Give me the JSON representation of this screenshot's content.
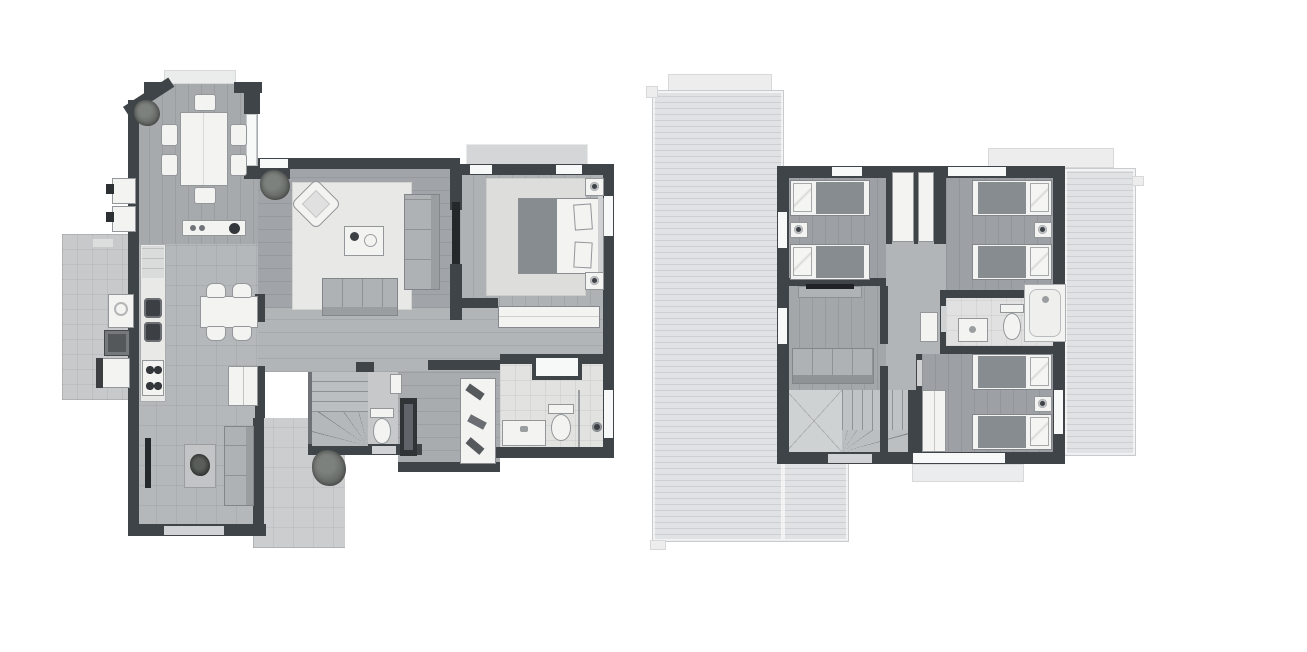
{
  "canvas": {
    "width_px": 1307,
    "height_px": 652,
    "background": "#ffffff"
  },
  "figure": {
    "type": "architectural-floor-plan",
    "style": "grayscale top-down 2D render, two storeys side by side",
    "plan_count": 2,
    "visible_text_labels": []
  },
  "colors": {
    "background": "#ffffff",
    "wall": "#3f4448",
    "wall_dark": "#24282b",
    "window": "#f7f8f8",
    "threshold": "#d0d2d3",
    "floor_wood": "#a1a5a9",
    "floor_wood_light": "#aeb2b5",
    "floor_tile_kitchen": "#b5b8ba",
    "floor_hall": "#b2b5b8",
    "floor_bath": "#e2e2e0",
    "rug": "#e8e8e6",
    "rug_bed": "#dddedc",
    "roof": "#e0e2e4",
    "roof_line": "#cdd0d2",
    "terrace": "#cbcdce",
    "patio": "#c7c9ca",
    "stairwell": "#cfd2d3",
    "furniture_white": "#f3f3f2",
    "furniture_outline": "#94979a",
    "sofa_gray": "#aeb2b5",
    "blanket": "#878c90",
    "counter": "#e9e9e8",
    "fixture_dark": "#3c4044",
    "plant": "#5f6360"
  },
  "plans": [
    {
      "id": "ground-floor",
      "side": "left",
      "rooms": [
        {
          "name": "dining-room",
          "items": [
            "dining-table",
            "dining-chair-x6",
            "plant",
            "entry-step",
            "chamfered-corner-wall"
          ]
        },
        {
          "name": "living-room",
          "items": [
            "area-rug",
            "sofa",
            "loveseat",
            "armchair",
            "coffee-table",
            "plant"
          ]
        },
        {
          "name": "master-bedroom",
          "items": [
            "double-bed",
            "pillow-x2",
            "nightstand-x2",
            "table-lamp-x2",
            "area-rug",
            "wall-tv",
            "terrace-deck",
            "window-x3"
          ]
        },
        {
          "name": "kitchen",
          "items": [
            "counter-run",
            "double-sink",
            "cooktop",
            "refrigerator",
            "breakfast-table",
            "chair-x4",
            "island-counter"
          ]
        },
        {
          "name": "family-room",
          "items": [
            "sofa",
            "side-table-with-plant",
            "wall-tv",
            "terrace-door"
          ]
        },
        {
          "name": "hallway",
          "items": [
            "built-in-wardrobe"
          ]
        },
        {
          "name": "walk-in-closet",
          "items": [
            "shelving-unit",
            "tall-cabinet"
          ]
        },
        {
          "name": "bathroom",
          "items": [
            "vanity-sink",
            "toilet",
            "shower",
            "window",
            "niche"
          ]
        },
        {
          "name": "powder-room",
          "items": [
            "toilet",
            "hand-basin"
          ]
        },
        {
          "name": "staircase",
          "items": [
            "straight-treads",
            "winder-treads"
          ]
        },
        {
          "name": "laundry-patio",
          "items": [
            "washer",
            "dryer",
            "utility-sink",
            "meter-box-x2",
            "step"
          ]
        },
        {
          "name": "terrace",
          "items": [
            "plant",
            "tiled-floor"
          ]
        }
      ]
    },
    {
      "id": "upper-floor",
      "side": "right",
      "rooms": [
        {
          "name": "bedroom-2",
          "items": [
            "twin-bed-x2",
            "pillow-x2",
            "nightstand",
            "table-lamp",
            "closet"
          ]
        },
        {
          "name": "bedroom-3",
          "items": [
            "twin-bed-x2",
            "pillow-x2",
            "nightstand",
            "table-lamp",
            "closet"
          ]
        },
        {
          "name": "bedroom-4",
          "items": [
            "twin-bed-x2",
            "pillow-x2",
            "nightstand",
            "table-lamp",
            "closet"
          ]
        },
        {
          "name": "tv-lounge",
          "items": [
            "sofa",
            "tv-console"
          ]
        },
        {
          "name": "bathroom",
          "items": [
            "vanity-sink",
            "toilet",
            "bathtub"
          ]
        },
        {
          "name": "hallway",
          "items": [
            "linen-closet"
          ]
        },
        {
          "name": "staircase",
          "items": [
            "treads",
            "winder-fan",
            "stairwell-void"
          ]
        },
        {
          "name": "roof",
          "items": [
            "roof-plane-left",
            "roof-plane-right",
            "ridge-cap-x2",
            "gutter-nub-x3",
            "balcony-ledge"
          ]
        }
      ]
    }
  ]
}
